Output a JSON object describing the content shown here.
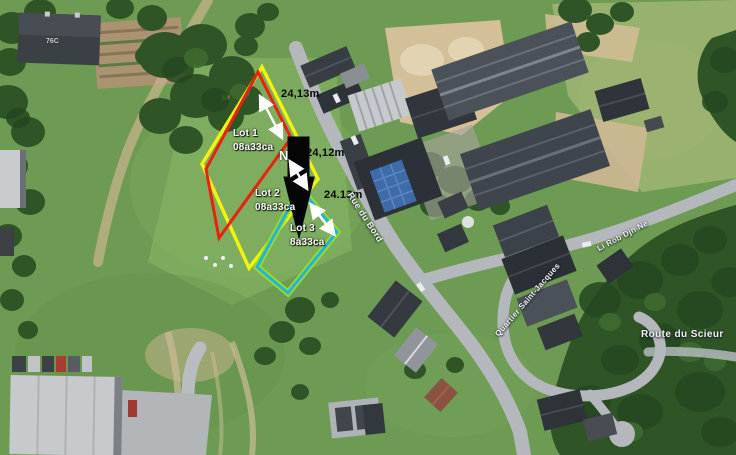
{
  "map": {
    "region_label": "76C",
    "north_indicator": "N",
    "streets": {
      "rue_du_bord": "Rue du Bord",
      "li_rob_djn_ne": "Li Rob Djn Ne",
      "quartier_saint_jacques": "Quartier Saint-Jacques",
      "route_du_scieur": "Route du Scieur"
    },
    "lots": [
      {
        "name": "Lot 1",
        "area": "08a33ca",
        "frontage": "24,13m",
        "outline_color": "#e8220e"
      },
      {
        "name": "Lot 2",
        "area": "08a33ca",
        "frontage": "24,12m",
        "outline_color": "#f2f40c"
      },
      {
        "name": "Lot 3",
        "area": "8a33ca",
        "frontage": "24.13m",
        "outline_color": "#23b3e2"
      }
    ],
    "colors": {
      "lot1_outline": "#e8220e",
      "lot2_outline": "#f2f40c",
      "lot3_outline": "#23b3e2",
      "lot3_outer_halo": "#9ade1c",
      "direction_arrow": "#050505",
      "measurement_arrow": "#ffffff",
      "measurement_text": "#050505",
      "label_text": "#ffffff"
    }
  }
}
